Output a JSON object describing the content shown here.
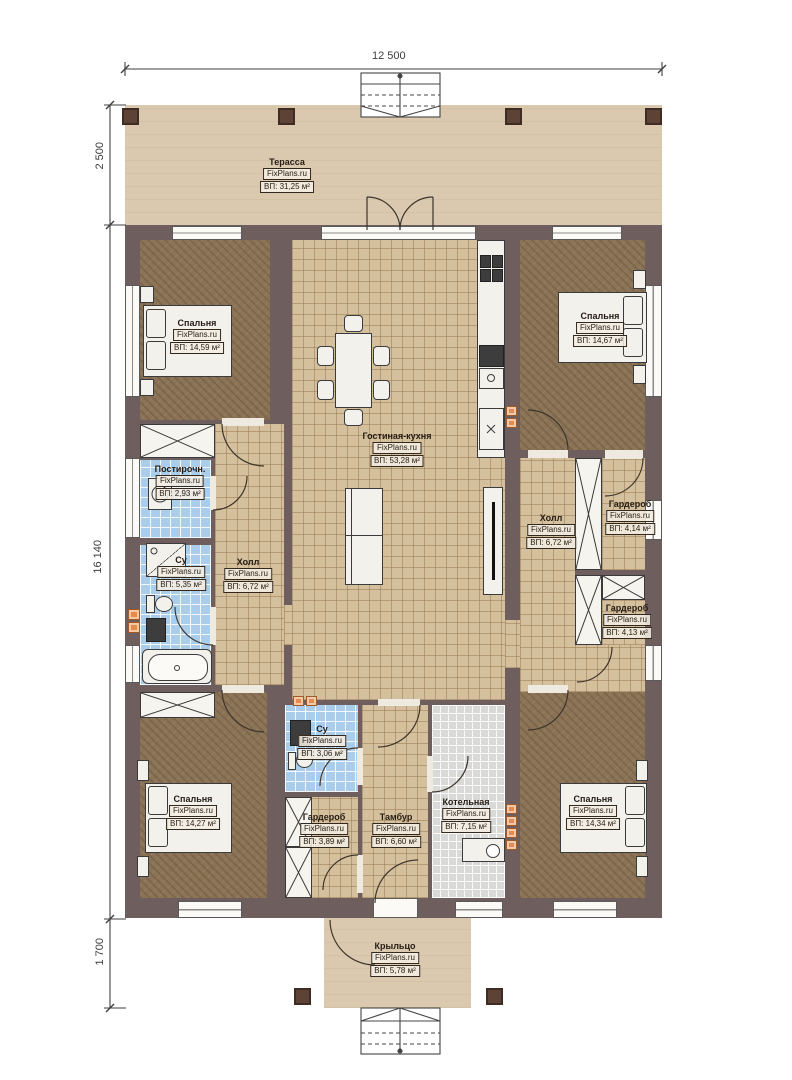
{
  "watermark": "FixPlans.ru",
  "dimensions": {
    "width_total": "12 500",
    "terrace_depth": "2 500",
    "house_depth": "16 140",
    "porch_depth": "1 700"
  },
  "rooms": {
    "terrace": {
      "name": "Терасса",
      "area": "ВП: 31,25 м²"
    },
    "living": {
      "name": "Гостиная-кухня",
      "area": "ВП: 53,28 м²"
    },
    "bedroom_tl": {
      "name": "Спальня",
      "area": "ВП: 14,59 м²"
    },
    "bedroom_tr": {
      "name": "Спальня",
      "area": "ВП: 14,67 м²"
    },
    "laundry": {
      "name": "Постирочн.",
      "area": "ВП: 2,93 м²"
    },
    "bath_main": {
      "name": "Су",
      "area": "ВП: 5,35 м²"
    },
    "hall_left": {
      "name": "Холл",
      "area": "ВП: 6,72 м²"
    },
    "hall_right": {
      "name": "Холл",
      "area": "ВП: 6,72 м²"
    },
    "wardrobe_rt": {
      "name": "Гардероб",
      "area": "ВП: 4,14 м²"
    },
    "wardrobe_rb": {
      "name": "Гардероб",
      "area": "ВП: 4,13 м²"
    },
    "bath_small": {
      "name": "Су",
      "area": "ВП: 3,06 м²"
    },
    "wardrobe_bottom": {
      "name": "Гардероб",
      "area": "ВП: 3,89 м²"
    },
    "vestibule": {
      "name": "Тамбур",
      "area": "ВП: 6,60 м²"
    },
    "boiler": {
      "name": "Котельная",
      "area": "ВП: 7,15 м²"
    },
    "bedroom_bl": {
      "name": "Спальня",
      "area": "ВП: 14,27 м²"
    },
    "bedroom_br": {
      "name": "Спальня",
      "area": "ВП: 14,34 м²"
    },
    "porch": {
      "name": "Крыльцо",
      "area": "ВП: 5,78 м²"
    }
  },
  "colors": {
    "wall": "#6f5e5e",
    "terrace_floor": "#dac9ae",
    "bedroom_floor": "#8b7356",
    "tile_floor": "#d4c09c",
    "wet_tile": "#a9cdeb",
    "boiler_tile": "#d9d9d7",
    "accent_radiator": "#e78a4e"
  }
}
